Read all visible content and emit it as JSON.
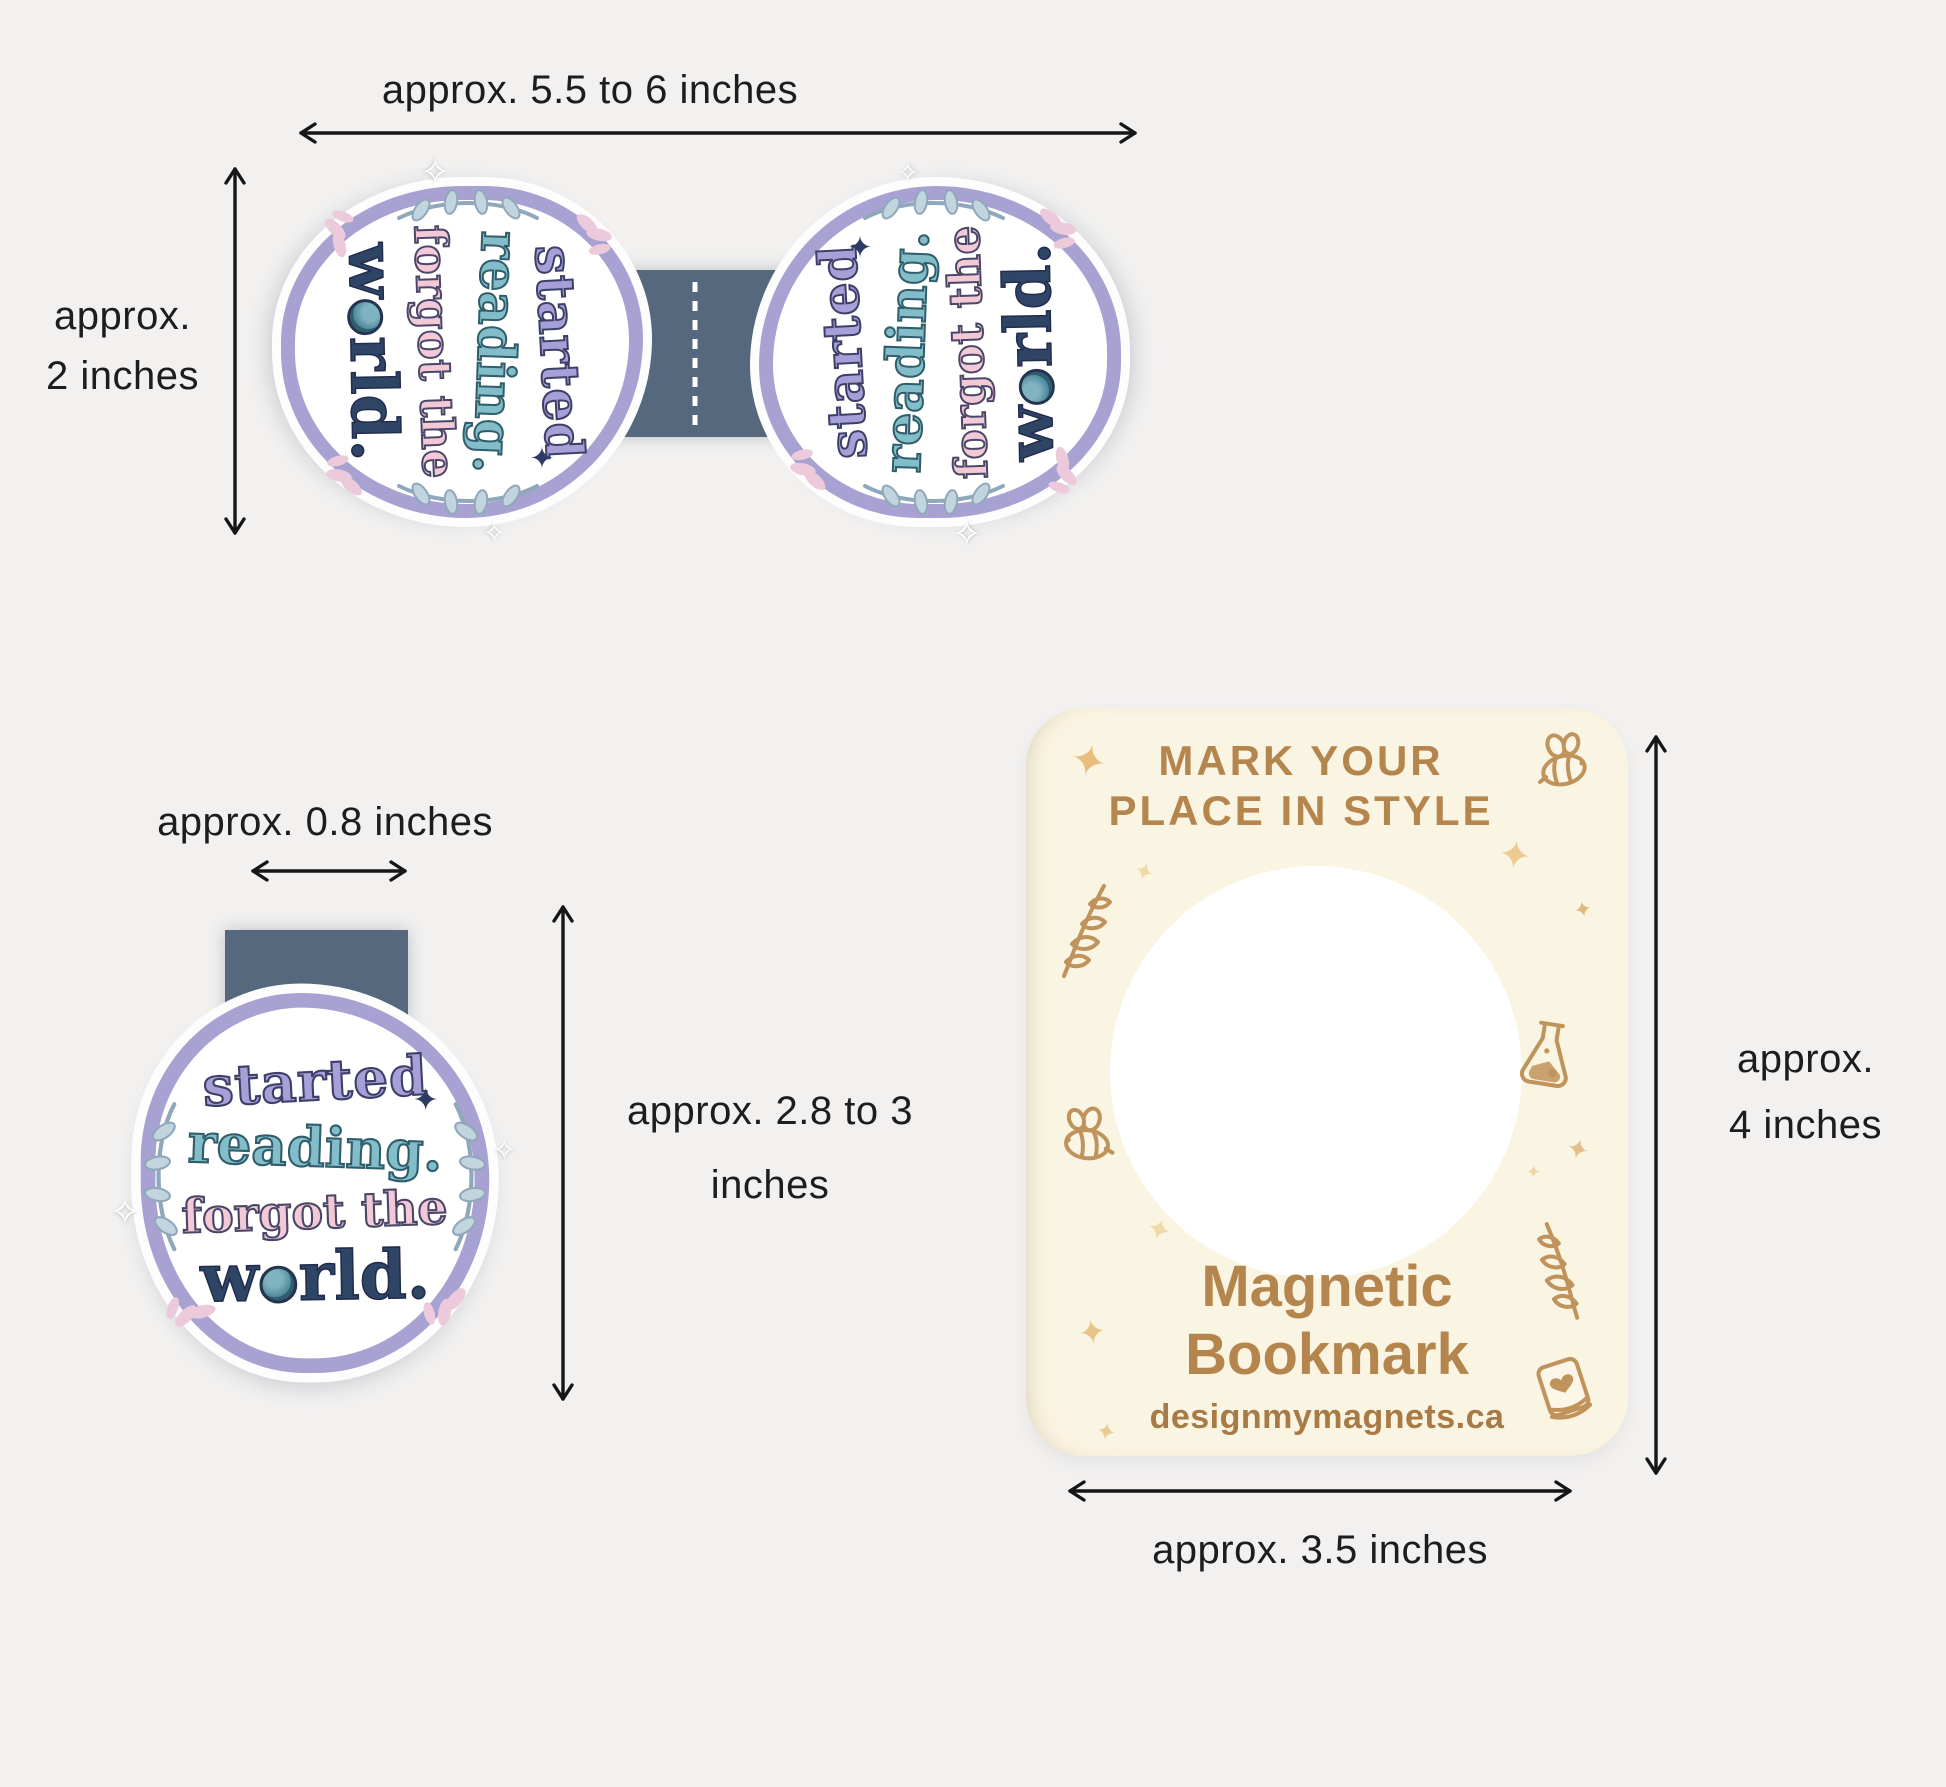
{
  "colors": {
    "bg": "#f2f1f0",
    "text": "#1d1d1f",
    "arrow": "#161616",
    "strip": "#56687e",
    "lavender": "#a7a2d2",
    "quote-purple": "#a79fd8",
    "quote-teal": "#83bdca",
    "quote-pink": "#f3c9d7",
    "quote-navy": "#2e4566",
    "card-bg": "#faf4e2",
    "card-brown": "#b5854e",
    "card-brown-dark": "#a87a45",
    "tan": "#c0935c",
    "tan-light": "#ecca92"
  },
  "glyphs": {
    "sparkle": "✦",
    "sparkle_open": "✧"
  },
  "sticker": {
    "line1": "started",
    "line2": "reading.",
    "line3": "forgot the",
    "line4_pre": "w",
    "line4_post": "rld."
  },
  "unfolded": {
    "width_label": "approx. 5.5 to 6 inches",
    "height_label_line1": "approx.",
    "height_label_line2": "2 inches"
  },
  "folded": {
    "width_label": "approx. 0.8 inches",
    "height_label_line1": "approx. 2.8 to 3",
    "height_label_line2": "inches"
  },
  "card": {
    "title_line1": "MARK YOUR",
    "title_line2": "PLACE IN STYLE",
    "product_line1": "Magnetic",
    "product_line2": "Bookmark",
    "website": "designmymagnets.ca",
    "height_label_line1": "approx.",
    "height_label_line2": "4 inches",
    "width_label": "approx. 3.5 inches"
  }
}
